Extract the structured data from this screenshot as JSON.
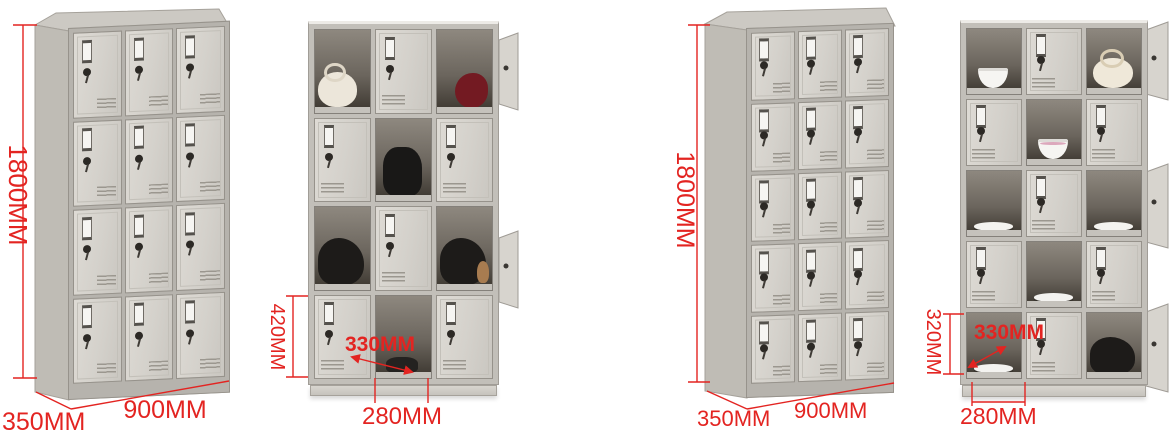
{
  "image_type": "product dimension photo set of metal storage lockers",
  "background": "#ffffff",
  "annotation_color": "#e32421",
  "cabinet_colors": {
    "door": "#d6d3cd",
    "frame": "#c2bfb9",
    "side_panel": "#bfbcb5",
    "interior": "#4a443c"
  },
  "figures": [
    {
      "name": "twelve-door-locker-closed",
      "view": "three-quarter",
      "columns": 3,
      "rows": 4,
      "door_count": 12,
      "dims": {
        "height": "1800MM",
        "depth": "350MM",
        "width": "900MM"
      }
    },
    {
      "name": "twelve-door-locker-open",
      "view": "front",
      "columns": 3,
      "rows": 4,
      "door_count": 12,
      "dims": {
        "compartment_height": "420MM",
        "compartment_width": "330MM",
        "door_width": "280MM"
      },
      "contents": [
        "cream shoulder bag",
        "red bag",
        "black backpack",
        "black bag",
        "black bag with teddy bear",
        "dark shoes"
      ]
    },
    {
      "name": "fifteen-door-locker-closed",
      "view": "three-quarter",
      "columns": 3,
      "rows": 5,
      "door_count": 15,
      "dims": {
        "height": "1800MM",
        "depth": "350MM",
        "width": "900MM"
      }
    },
    {
      "name": "fifteen-door-locker-open",
      "view": "front",
      "columns": 3,
      "rows": 5,
      "door_count": 15,
      "dims": {
        "compartment_height": "320MM",
        "compartment_width": "330MM",
        "door_width": "280MM"
      },
      "contents": [
        "white bowl",
        "cream handbag",
        "pink-trimmed bowl",
        "white plate",
        "white plate",
        "white plate",
        "white plate",
        "black bag"
      ]
    }
  ]
}
